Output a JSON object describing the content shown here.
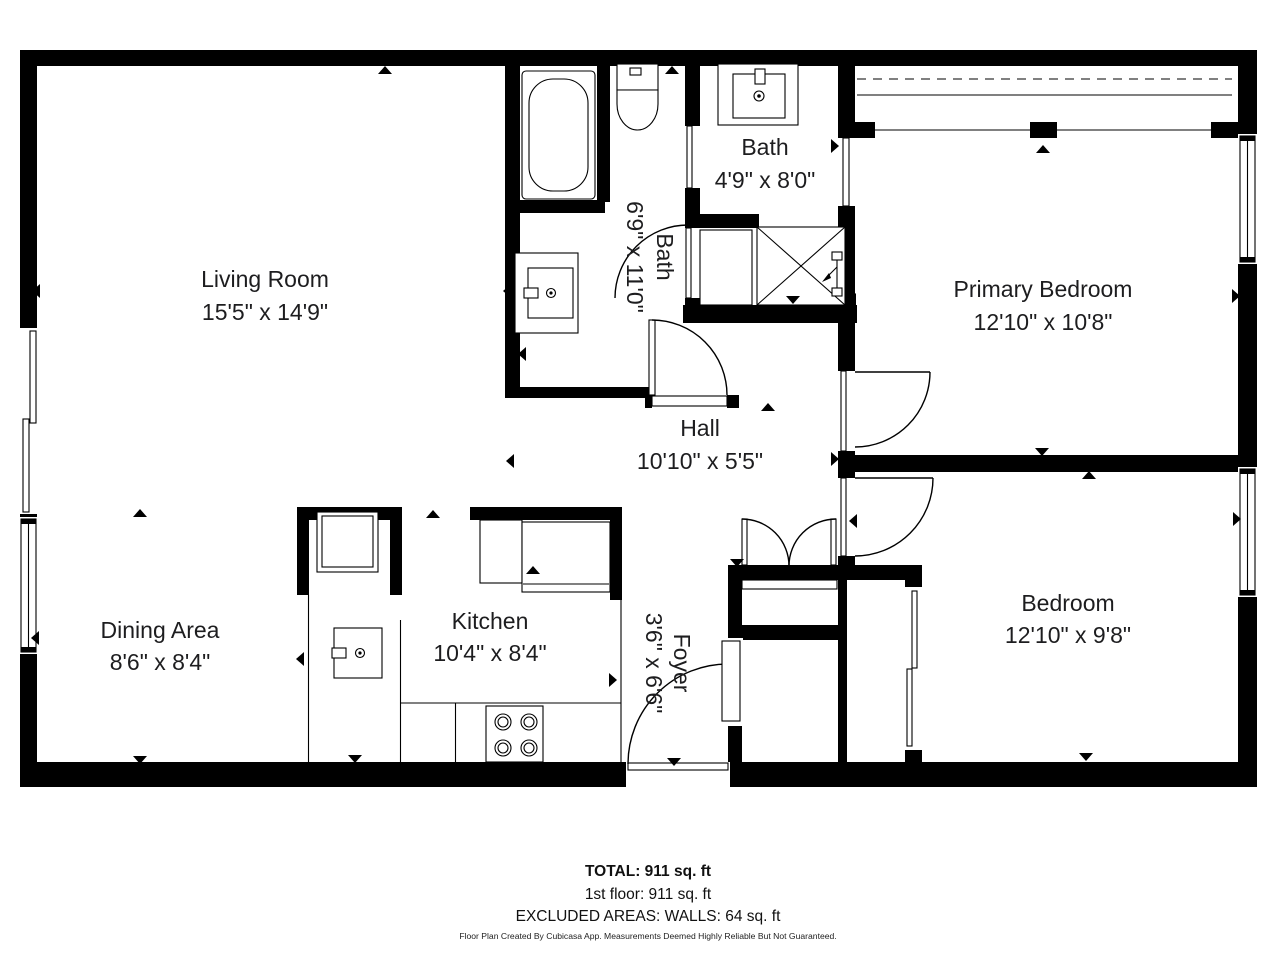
{
  "floorplan": {
    "rooms": {
      "living_room": {
        "name": "Living Room",
        "dims": "15'5\" x 14'9\""
      },
      "bath_main": {
        "name": "Bath",
        "dims": "6'9\" x 11'0\""
      },
      "bath_small": {
        "name": "Bath",
        "dims": "4'9\" x 8'0\""
      },
      "primary_bedroom": {
        "name": "Primary Bedroom",
        "dims": "12'10\" x 10'8\""
      },
      "hall": {
        "name": "Hall",
        "dims": "10'10\" x 5'5\""
      },
      "dining_area": {
        "name": "Dining Area",
        "dims": "8'6\" x 8'4\""
      },
      "kitchen": {
        "name": "Kitchen",
        "dims": "10'4\" x 8'4\""
      },
      "foyer": {
        "name": "Foyer",
        "dims": "3'6\" x 6'6\""
      },
      "bedroom": {
        "name": "Bedroom",
        "dims": "12'10\" x 9'8\""
      }
    },
    "summary": {
      "total": "TOTAL: 911 sq. ft",
      "first_floor": "1st floor: 911 sq. ft",
      "excluded": "EXCLUDED AREAS: WALLS: 64 sq. ft"
    },
    "disclaimer": "Floor Plan Created By Cubicasa App. Measurements Deemed Highly Reliable But Not Guaranteed.",
    "colors": {
      "wall": "#000000",
      "text": "#1d1d1f",
      "background": "#ffffff"
    }
  }
}
